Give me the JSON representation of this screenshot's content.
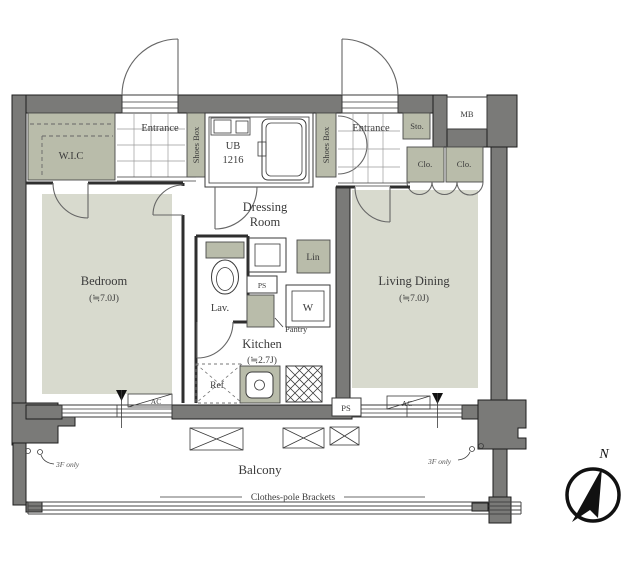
{
  "labels": {
    "wic": "W.I.C",
    "entrance_left": "Entrance",
    "entrance_right": "Entrance",
    "shoes_box_left": "Shoes Box",
    "shoes_box_right": "Shoes Box",
    "ub_line1": "UB",
    "ub_line2": "1216",
    "sto": "Sto.",
    "mb": "MB",
    "clo_left": "Clo.",
    "clo_right": "Clo.",
    "dressing_line1": "Dressing",
    "dressing_line2": "Room",
    "bedroom": "Bedroom",
    "bedroom_size": "(≒7.0J)",
    "living_dining": "Living Dining",
    "living_dining_size": "(≒7.0J)",
    "kitchen": "Kitchen",
    "kitchen_size": "(≒2.7J)",
    "lav": "Lav.",
    "lin": "Lin",
    "washer": "W",
    "ps_dressing": "PS",
    "ps_wall": "PS",
    "pantry": "Pantry",
    "ref": "Ref",
    "ac_bedroom": "AC",
    "ac_living": "AC",
    "balcony": "Balcony",
    "clothes_pole": "Clothes-pole Brackets",
    "note_left": "3F only",
    "note_right": "3F only",
    "north": "N"
  },
  "colors": {
    "wall": "#7a7a78",
    "floor": "#d8dace",
    "cabinet": "#b9bcaa",
    "line": "#3a3a3a"
  }
}
